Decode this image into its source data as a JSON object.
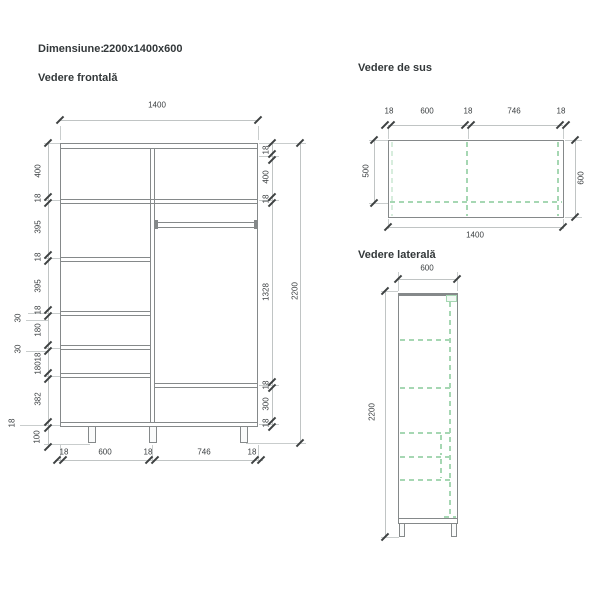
{
  "header": {
    "dimension_label": "Dimensiune:",
    "dimension_value": "2200x1400x600"
  },
  "front_view": {
    "title": "Vedere frontală",
    "width_total": "1400",
    "height_total": "2200",
    "right_chain": [
      "18",
      "400",
      "18",
      "1328",
      "18",
      "300",
      "18"
    ],
    "left_chain": [
      "400",
      "18",
      "395",
      "18",
      "395",
      "18",
      "180",
      "18",
      "180",
      "382"
    ],
    "left_outer": [
      "30",
      "30",
      "18"
    ],
    "legs_height": "100",
    "bottom_chain": [
      "18",
      "600",
      "18",
      "746",
      "18"
    ]
  },
  "top_view": {
    "title": "Vedere de sus",
    "top_chain": [
      "18",
      "600",
      "18",
      "746",
      "18"
    ],
    "depth_front": "500",
    "depth_total": "600",
    "width_total": "1400"
  },
  "side_view": {
    "title": "Vedere laterală",
    "depth_total": "600",
    "height_total": "2200"
  },
  "colors": {
    "line": "#85898a",
    "dim_line": "#c0c4c4",
    "tick": "#3d4142",
    "text": "#3a3e40",
    "green_dash": "#a6d7b3"
  }
}
